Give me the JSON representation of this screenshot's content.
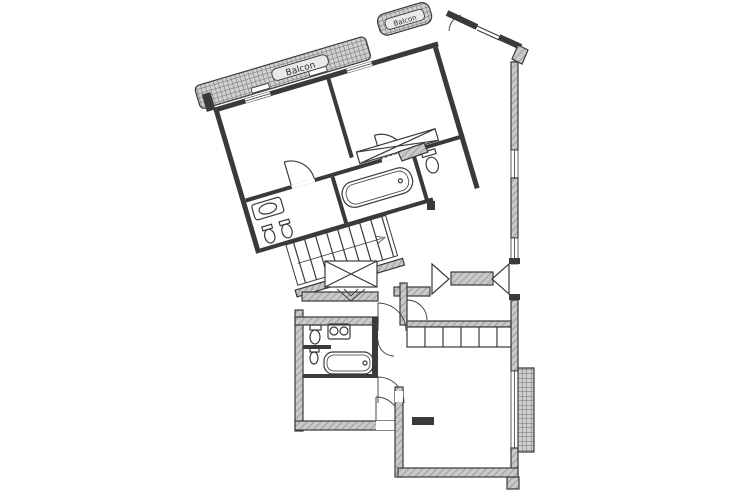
{
  "page": {
    "width": 743,
    "height": 497,
    "background": "#ffffff"
  },
  "colors": {
    "ink": "#3a3a3a",
    "wall_hatch_base": "#c9c9c9",
    "wall_hatch_line": "#8a8a8a",
    "balcony_grid_base": "#cfcfcf",
    "balcony_grid_line": "#6f6f6f"
  },
  "plan": {
    "type": "apartment-floor-plan",
    "labels": {
      "balcony_large": "Balcon",
      "balcony_small": "Balcon"
    }
  }
}
